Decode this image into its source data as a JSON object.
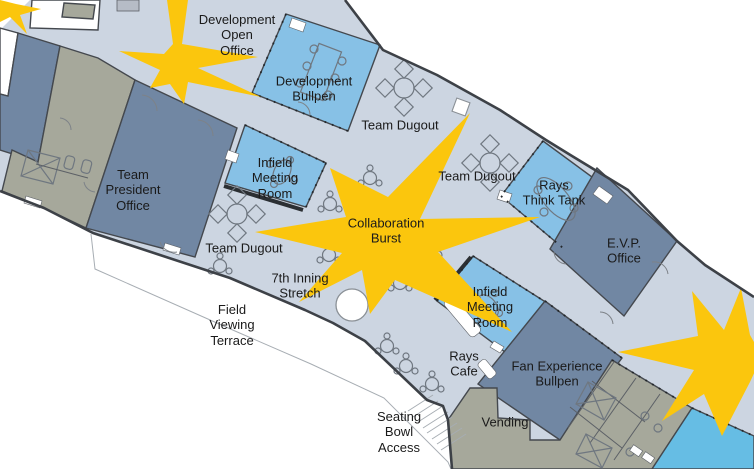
{
  "plan": {
    "type": "floor-plan",
    "icons": [
      "round-table-icon",
      "diamond-chair-icon",
      "conference-table-icon",
      "cafe-table-icon",
      "column-icon",
      "stairs-icon",
      "door-arc-icon",
      "toilet-icon",
      "storage-x-icon"
    ]
  },
  "colors": {
    "floor": "#ccd5e1",
    "slate": "#7187a3",
    "lightblue": "#87c1e6",
    "cyan": "#66bde4",
    "gray": "#a6a89b",
    "yellow": "#fbc60d",
    "wall": "#3d4147",
    "outside": "#ffffff",
    "text": "#1a1a1a"
  },
  "labels": [
    {
      "id": "development-open-office",
      "text": "Development\nOpen\nOffice",
      "x": 237,
      "y": 35
    },
    {
      "id": "development-bullpen",
      "text": "Development\nBullpen",
      "x": 314,
      "y": 89
    },
    {
      "id": "team-dugout-1",
      "text": "Team Dugout",
      "x": 400,
      "y": 125
    },
    {
      "id": "infield-meeting-room-1",
      "text": "Infield\nMeeting\nRoom",
      "x": 275,
      "y": 178
    },
    {
      "id": "team-dugout-2",
      "text": "Team Dugout",
      "x": 477,
      "y": 176
    },
    {
      "id": "rays-think-tank",
      "text": "Rays\nThink Tank",
      "x": 554,
      "y": 193
    },
    {
      "id": "team-president-office",
      "text": "Team\nPresident\nOffice",
      "x": 133,
      "y": 190
    },
    {
      "id": "collaboration-burst",
      "text": "Collaboration\nBurst",
      "x": 386,
      "y": 231
    },
    {
      "id": "team-dugout-3",
      "text": "Team Dugout",
      "x": 244,
      "y": 248
    },
    {
      "id": "evp-office",
      "text": "E.V.P.\nOffice",
      "x": 624,
      "y": 251
    },
    {
      "id": "seventh-inning-stretch",
      "text": "7th Inning\nStretch",
      "x": 300,
      "y": 286
    },
    {
      "id": "infield-meeting-room-2",
      "text": "Infield\nMeeting\nRoom",
      "x": 490,
      "y": 307
    },
    {
      "id": "field-viewing-terrace",
      "text": "Field\nViewing\nTerrace",
      "x": 232,
      "y": 325
    },
    {
      "id": "rays-cafe",
      "text": "Rays\nCafe",
      "x": 464,
      "y": 364
    },
    {
      "id": "fan-experience-bullpen",
      "text": "Fan Experience\nBullpen",
      "x": 557,
      "y": 374
    },
    {
      "id": "vending",
      "text": "Vending",
      "x": 505,
      "y": 422
    },
    {
      "id": "seating-bowl-access",
      "text": "Seating\nBowl\nAccess",
      "x": 399,
      "y": 432
    }
  ]
}
